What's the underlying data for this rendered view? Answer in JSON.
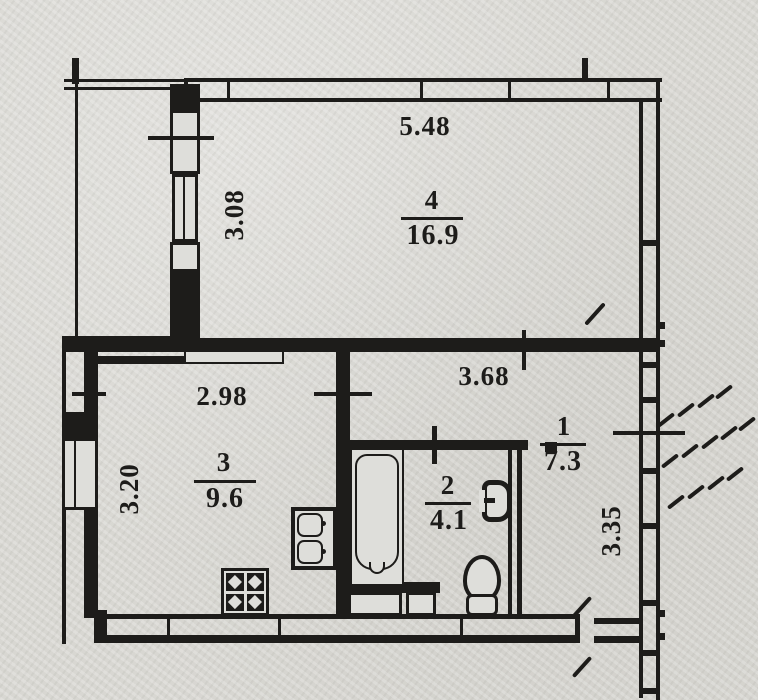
{
  "plan_title": "apartment-floor-plan",
  "colors": {
    "ink": "#1d1c1a",
    "paper": "#d8d7d2"
  },
  "rooms": [
    {
      "number": "4",
      "area": "16.9"
    },
    {
      "number": "3",
      "area": "9.6"
    },
    {
      "number": "2",
      "area": "4.1"
    },
    {
      "number": "1",
      "area": "7.3"
    }
  ],
  "dimensions": {
    "room4_width": "5.48",
    "balcony_depth": "3.08",
    "kitchen_width": "2.98",
    "kitchen_depth": "3.20",
    "hall_width": "3.68",
    "right_side": "3.35"
  },
  "fixtures": [
    {
      "name": "bathtub"
    },
    {
      "name": "toilet"
    },
    {
      "name": "washbasin"
    },
    {
      "name": "kitchen-sink"
    },
    {
      "name": "stove"
    }
  ]
}
